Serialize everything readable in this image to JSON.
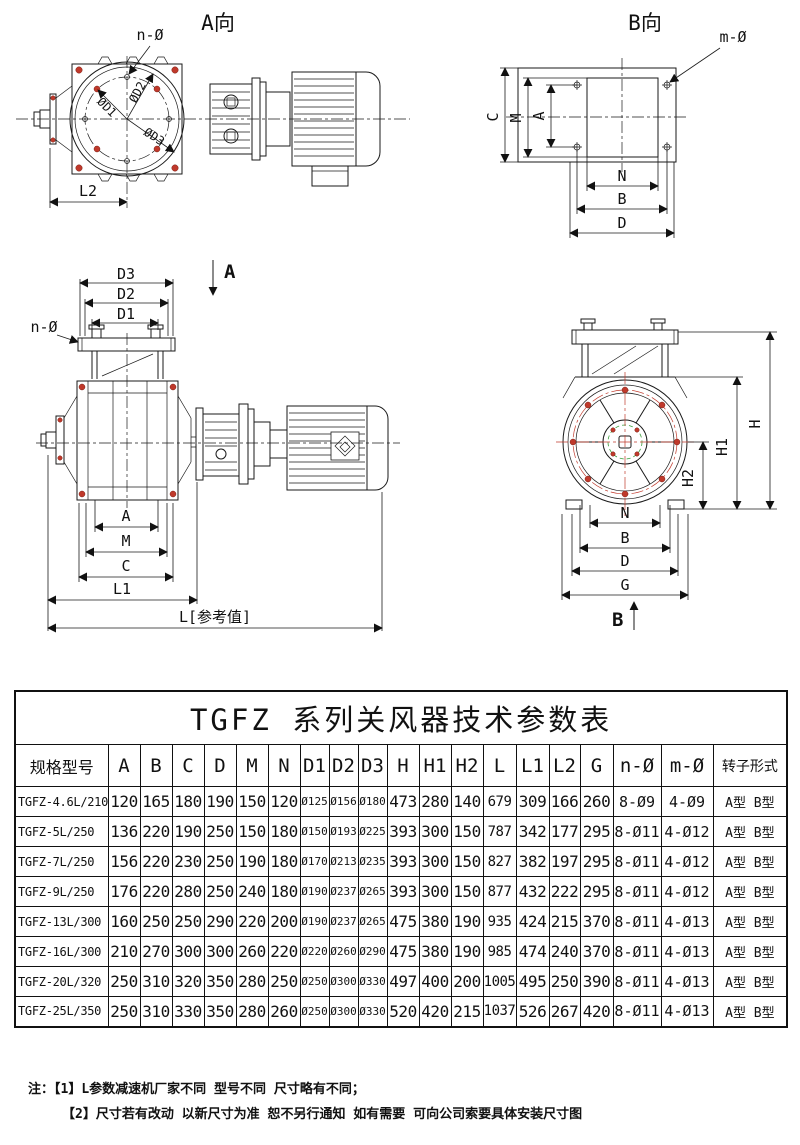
{
  "views": {
    "a": {
      "title": "A向",
      "labels": {
        "n_hole": "n-Ø",
        "d1": "ØD1",
        "d2": "ØD2",
        "d3": "ØD3",
        "l2": "L2"
      }
    },
    "b": {
      "title": "B向",
      "labels": {
        "m_hole": "m-Ø",
        "c": "C",
        "m": "M",
        "a": "A",
        "n": "N",
        "b": "B",
        "d": "D"
      }
    },
    "front": {
      "labels": {
        "d3": "D3",
        "d2": "D2",
        "d1": "D1",
        "n_hole": "n-Ø",
        "section": "A",
        "a": "A",
        "m": "M",
        "c": "C",
        "l1": "L1",
        "l_ref": "L[参考值]"
      }
    },
    "end": {
      "labels": {
        "h": "H",
        "h1": "H1",
        "h2": "H2",
        "n": "N",
        "b": "B",
        "d": "D",
        "g": "G",
        "section": "B"
      }
    }
  },
  "table": {
    "title": "TGFZ 系列关风器技术参数表",
    "columns": [
      "规格型号",
      "A",
      "B",
      "C",
      "D",
      "M",
      "N",
      "D1",
      "D2",
      "D3",
      "H",
      "H1",
      "H2",
      "L",
      "L1",
      "L2",
      "G",
      "n-Ø",
      "m-Ø",
      "转子形式"
    ],
    "rows": [
      [
        "TGFZ-4.6L/210",
        "120",
        "165",
        "180",
        "190",
        "150",
        "120",
        "Ø125",
        "Ø156",
        "Ø180",
        "473",
        "280",
        "140",
        "679",
        "309",
        "166",
        "260",
        "8-Ø9",
        "4-Ø9",
        "A型 B型"
      ],
      [
        "TGFZ-5L/250",
        "136",
        "220",
        "190",
        "250",
        "150",
        "180",
        "Ø150",
        "Ø193",
        "Ø225",
        "393",
        "300",
        "150",
        "787",
        "342",
        "177",
        "295",
        "8-Ø11",
        "4-Ø12",
        "A型 B型"
      ],
      [
        "TGFZ-7L/250",
        "156",
        "220",
        "230",
        "250",
        "190",
        "180",
        "Ø170",
        "Ø213",
        "Ø235",
        "393",
        "300",
        "150",
        "827",
        "382",
        "197",
        "295",
        "8-Ø11",
        "4-Ø12",
        "A型 B型"
      ],
      [
        "TGFZ-9L/250",
        "176",
        "220",
        "280",
        "250",
        "240",
        "180",
        "Ø190",
        "Ø237",
        "Ø265",
        "393",
        "300",
        "150",
        "877",
        "432",
        "222",
        "295",
        "8-Ø11",
        "4-Ø12",
        "A型 B型"
      ],
      [
        "TGFZ-13L/300",
        "160",
        "250",
        "250",
        "290",
        "220",
        "200",
        "Ø190",
        "Ø237",
        "Ø265",
        "475",
        "380",
        "190",
        "935",
        "424",
        "215",
        "370",
        "8-Ø11",
        "4-Ø13",
        "A型 B型"
      ],
      [
        "TGFZ-16L/300",
        "210",
        "270",
        "300",
        "300",
        "260",
        "220",
        "Ø220",
        "Ø260",
        "Ø290",
        "475",
        "380",
        "190",
        "985",
        "474",
        "240",
        "370",
        "8-Ø11",
        "4-Ø13",
        "A型 B型"
      ],
      [
        "TGFZ-20L/320",
        "250",
        "310",
        "320",
        "350",
        "280",
        "250",
        "Ø250",
        "Ø300",
        "Ø330",
        "497",
        "400",
        "200",
        "1005",
        "495",
        "250",
        "390",
        "8-Ø11",
        "4-Ø13",
        "A型 B型"
      ],
      [
        "TGFZ-25L/350",
        "250",
        "310",
        "330",
        "350",
        "280",
        "260",
        "Ø250",
        "Ø300",
        "Ø330",
        "520",
        "420",
        "215",
        "1037",
        "526",
        "267",
        "420",
        "8-Ø11",
        "4-Ø13",
        "A型 B型"
      ]
    ]
  },
  "notes": {
    "label": "注：",
    "items": [
      "【1】L参数减速机厂家不同 型号不同 尺寸略有不同；",
      "【2】尺寸若有改动 以新尺寸为准 恕不另行通知 如有需要 可向公司索要具体安装尺寸图"
    ]
  },
  "colors": {
    "line": "#1a1a1a",
    "accent_red": "#c0392b",
    "accent_green": "#3c9e3c"
  }
}
